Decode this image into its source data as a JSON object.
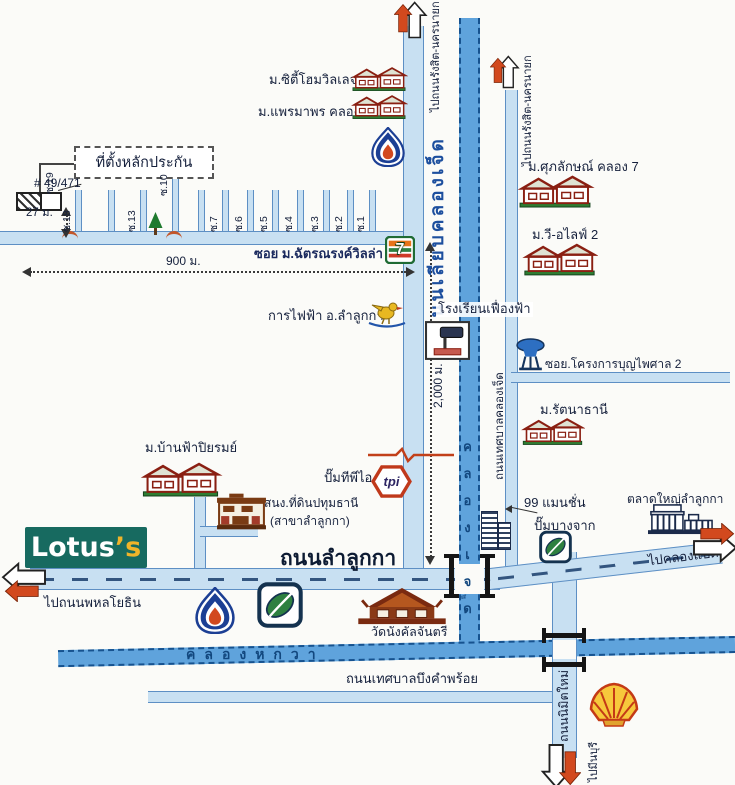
{
  "colors": {
    "road_fill": "#c8e0f2",
    "road_edge": "#5d8fc4",
    "canal_fill": "#5fa3dc",
    "canal_edge": "#16528f",
    "label_dark": "#15203c",
    "road_label_blue": "#1d4f9e",
    "lotus_teal": "#176a60",
    "lotus_yellow": "#f0b429",
    "arrow_orange": "#d2491e"
  },
  "collateral": {
    "box_label": "ที่ตั้งหลักประกัน",
    "house_no": "# 49/471",
    "soi19": "ซ.19"
  },
  "measure": {
    "d27": "27 ม.",
    "d900": "900 ม.",
    "d2000": "2,000 ม."
  },
  "sois": [
    "ซ.18",
    "ซ.13",
    "ซ.10",
    "ซ.7",
    "ซ.6",
    "ซ.5",
    "ซ.4",
    "ซ.3",
    "ซ.2",
    "ซ.1"
  ],
  "roads": {
    "chatnarong_soi": "ซอย ม.ฉัตรณรงค์วิลล่า 5",
    "liab_klong_jed": "ถนนเลียบคลองเจ็ด",
    "to_rangsit_1": "ไปถนนรังสิต-นครนายก",
    "to_rangsit_2": "ไปถนนรังสิต-นครนายก",
    "tessaban_klong_jed": "ถนนเทศบาลคลองเจ็ด",
    "lamlukka": "ถนนลำลูกกา",
    "to_phahonyothin": "ไปถนนพหลโยธิน",
    "to_klong_paed": "ไปคลองแปด",
    "tessaban_bueng": "ถนนเทศบาลบึงคำพร้อย",
    "nimit_mai": "ถนนนิมิตใหม่",
    "to_minburi": "ไปมีนบุรี"
  },
  "canals": {
    "klong_jed": "คลองเจ็ด",
    "klong_hok_wa": "คลองหกวา"
  },
  "places": {
    "city_home": "ม.ซิตี้โฮมวิลเลจ",
    "premaporn": "ม.แพรมาพร คลอง 7",
    "supalak": "ม.ศุภลักษณ์ คลอง 7",
    "we_alive": "ม.วี-อไลฟ์ 2",
    "electricity": "การไฟฟ้า อ.ลำลูกกา",
    "school": "โรงเรียนเฟื่องฟ้า",
    "boonpaisal_soi": "ซอย.โครงการบุญไพศาล 2",
    "rattanathani": "ม.รัตนาธานี",
    "baanfah": "ม.บ้านฟ้าปิยรมย์",
    "land_office_1": "สนง.ที่ดินปทุมธานี",
    "land_office_2": "(สาขาลำลูกกา)",
    "tpi_station": "ปั๊มทีพีไอ",
    "mansion_99": "99 แมนชั่น",
    "bangchak_station": "ปั๊มบางจาก",
    "market": "ตลาดใหญ่ลำลูกกา",
    "temple": "วัดนังคัลจันตรี"
  },
  "logos": {
    "lotus_main": "Lotus",
    "lotus_s": "’s",
    "seven": "7",
    "tpi": "tpi"
  }
}
